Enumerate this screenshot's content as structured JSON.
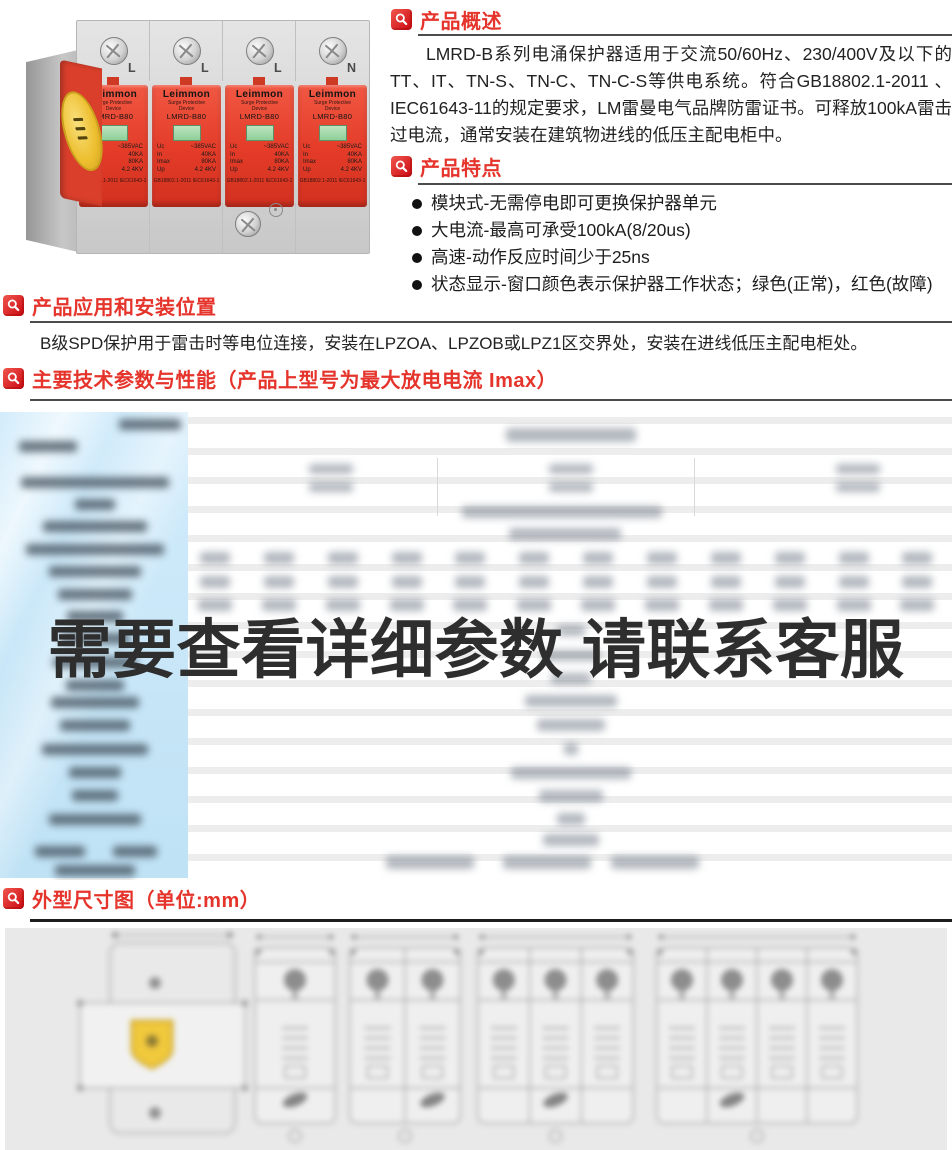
{
  "colors": {
    "accent_red": "#e5342b",
    "table_blue": "#c3e5f7",
    "panel_gray": "#e9e9e9",
    "overlay_text": "#2e2e2e"
  },
  "photo": {
    "terminals": [
      "L",
      "L",
      "L",
      "N"
    ],
    "module": {
      "brand": "Leimmon",
      "type_line1": "Surge Protective",
      "type_line2": "Device",
      "model": "LMRD-B80",
      "specs": [
        {
          "k": "Uc",
          "v": "~385VAC"
        },
        {
          "k": "In",
          "v": "40KA"
        },
        {
          "k": "Imax",
          "v": "80KA"
        },
        {
          "k": "Up",
          "v": "4.2 4KV"
        }
      ],
      "cert": "GB18802.1-2011 IEC61643-1"
    }
  },
  "overview": {
    "title": "产品概述",
    "text": "LMRD-B系列电涌保护器适用于交流50/60Hz、230/400V及以下的TT、IT、TN-S、TN-C、TN-C-S等供电系统。符合GB18802.1-2011 、IEC61643-11的规定要求，LM雷曼电气品牌防雷证书。可释放100kA雷击过电流，通常安装在建筑物进线的低压主配电柜中。"
  },
  "features": {
    "title": "产品特点",
    "items": [
      "模块式-无需停电即可更换保护器单元",
      "大电流-最高可承受100kA(8/20us)",
      "高速-动作反应时间少于25ns",
      "状态显示-窗口颜色表示保护器工作状态；绿色(正常)，红色(故障)"
    ]
  },
  "application": {
    "title": "产品应用和安装位置",
    "text": "B级SPD保护用于雷击时等电位连接，安装在LPZOA、LPZOB或LPZ1区交界处，安装在进线低压主配电柜处。"
  },
  "parameters": {
    "title": "主要技术参数与性能（产品上型号为最大放电电流 Imax）",
    "overlay_text": "需要查看详细参数 请联系客服",
    "blurred": true,
    "left_labels": [
      [
        150,
        7,
        62
      ],
      [
        48,
        29,
        58
      ],
      [
        95,
        65,
        148
      ],
      [
        95,
        87,
        40
      ],
      [
        95,
        109,
        104
      ],
      [
        95,
        132,
        138
      ],
      [
        95,
        154,
        92
      ],
      [
        95,
        177,
        74
      ],
      [
        95,
        199,
        56
      ],
      [
        95,
        221,
        70
      ],
      [
        95,
        245,
        84
      ],
      [
        95,
        268,
        58
      ],
      [
        95,
        285,
        88
      ],
      [
        95,
        308,
        70
      ],
      [
        95,
        332,
        106
      ],
      [
        95,
        355,
        52
      ],
      [
        95,
        378,
        46
      ],
      [
        95,
        402,
        92
      ],
      [
        60,
        434,
        50
      ],
      [
        135,
        434,
        44
      ],
      [
        95,
        453,
        80
      ]
    ],
    "body_blobs": [
      [
        571,
        16,
        130,
        14
      ],
      [
        331,
        52,
        44,
        10
      ],
      [
        571,
        52,
        44,
        10
      ],
      [
        858,
        52,
        44,
        10
      ],
      [
        331,
        70,
        44,
        10
      ],
      [
        571,
        70,
        44,
        10
      ],
      [
        858,
        70,
        44,
        10
      ],
      [
        562,
        94,
        200,
        12
      ],
      [
        565,
        116,
        112,
        12
      ],
      [
        215,
        140,
        30,
        12
      ],
      [
        279,
        140,
        30,
        12
      ],
      [
        343,
        140,
        30,
        12
      ],
      [
        407,
        140,
        30,
        12
      ],
      [
        470,
        140,
        30,
        12
      ],
      [
        534,
        140,
        30,
        12
      ],
      [
        598,
        140,
        30,
        12
      ],
      [
        662,
        140,
        30,
        12
      ],
      [
        726,
        140,
        30,
        12
      ],
      [
        790,
        140,
        30,
        12
      ],
      [
        854,
        140,
        30,
        12
      ],
      [
        917,
        140,
        30,
        12
      ],
      [
        215,
        164,
        30,
        12
      ],
      [
        279,
        164,
        30,
        12
      ],
      [
        343,
        164,
        30,
        12
      ],
      [
        407,
        164,
        30,
        12
      ],
      [
        470,
        164,
        30,
        12
      ],
      [
        534,
        164,
        30,
        12
      ],
      [
        598,
        164,
        30,
        12
      ],
      [
        662,
        164,
        30,
        12
      ],
      [
        726,
        164,
        30,
        12
      ],
      [
        790,
        164,
        30,
        12
      ],
      [
        854,
        164,
        30,
        12
      ],
      [
        917,
        164,
        30,
        12
      ],
      [
        215,
        187,
        34,
        12
      ],
      [
        279,
        187,
        34,
        12
      ],
      [
        343,
        187,
        34,
        12
      ],
      [
        407,
        187,
        34,
        12
      ],
      [
        470,
        187,
        34,
        12
      ],
      [
        534,
        187,
        34,
        12
      ],
      [
        598,
        187,
        34,
        12
      ],
      [
        662,
        187,
        34,
        12
      ],
      [
        726,
        187,
        34,
        12
      ],
      [
        790,
        187,
        34,
        12
      ],
      [
        854,
        187,
        34,
        12
      ],
      [
        917,
        187,
        34,
        12
      ],
      [
        571,
        213,
        28,
        11
      ],
      [
        571,
        238,
        58,
        11
      ],
      [
        571,
        261,
        40,
        11
      ],
      [
        571,
        283,
        92,
        12
      ],
      [
        571,
        307,
        68,
        12
      ],
      [
        571,
        331,
        14,
        12
      ],
      [
        571,
        355,
        120,
        12
      ],
      [
        571,
        378,
        64,
        12
      ],
      [
        571,
        401,
        28,
        12
      ],
      [
        571,
        422,
        56,
        12
      ],
      [
        430,
        444,
        88,
        13
      ],
      [
        547,
        444,
        88,
        13
      ],
      [
        655,
        444,
        88,
        13
      ]
    ]
  },
  "dimensions": {
    "title": "外型尺寸图（单位:mm）",
    "views": [
      {
        "type": "side"
      },
      {
        "type": "front",
        "poles": 1,
        "x": 250,
        "w": 80
      },
      {
        "type": "front",
        "poles": 2,
        "x": 345,
        "w": 110
      },
      {
        "type": "front",
        "poles": 3,
        "x": 473,
        "w": 155
      },
      {
        "type": "front",
        "poles": 4,
        "x": 652,
        "w": 200
      }
    ]
  }
}
